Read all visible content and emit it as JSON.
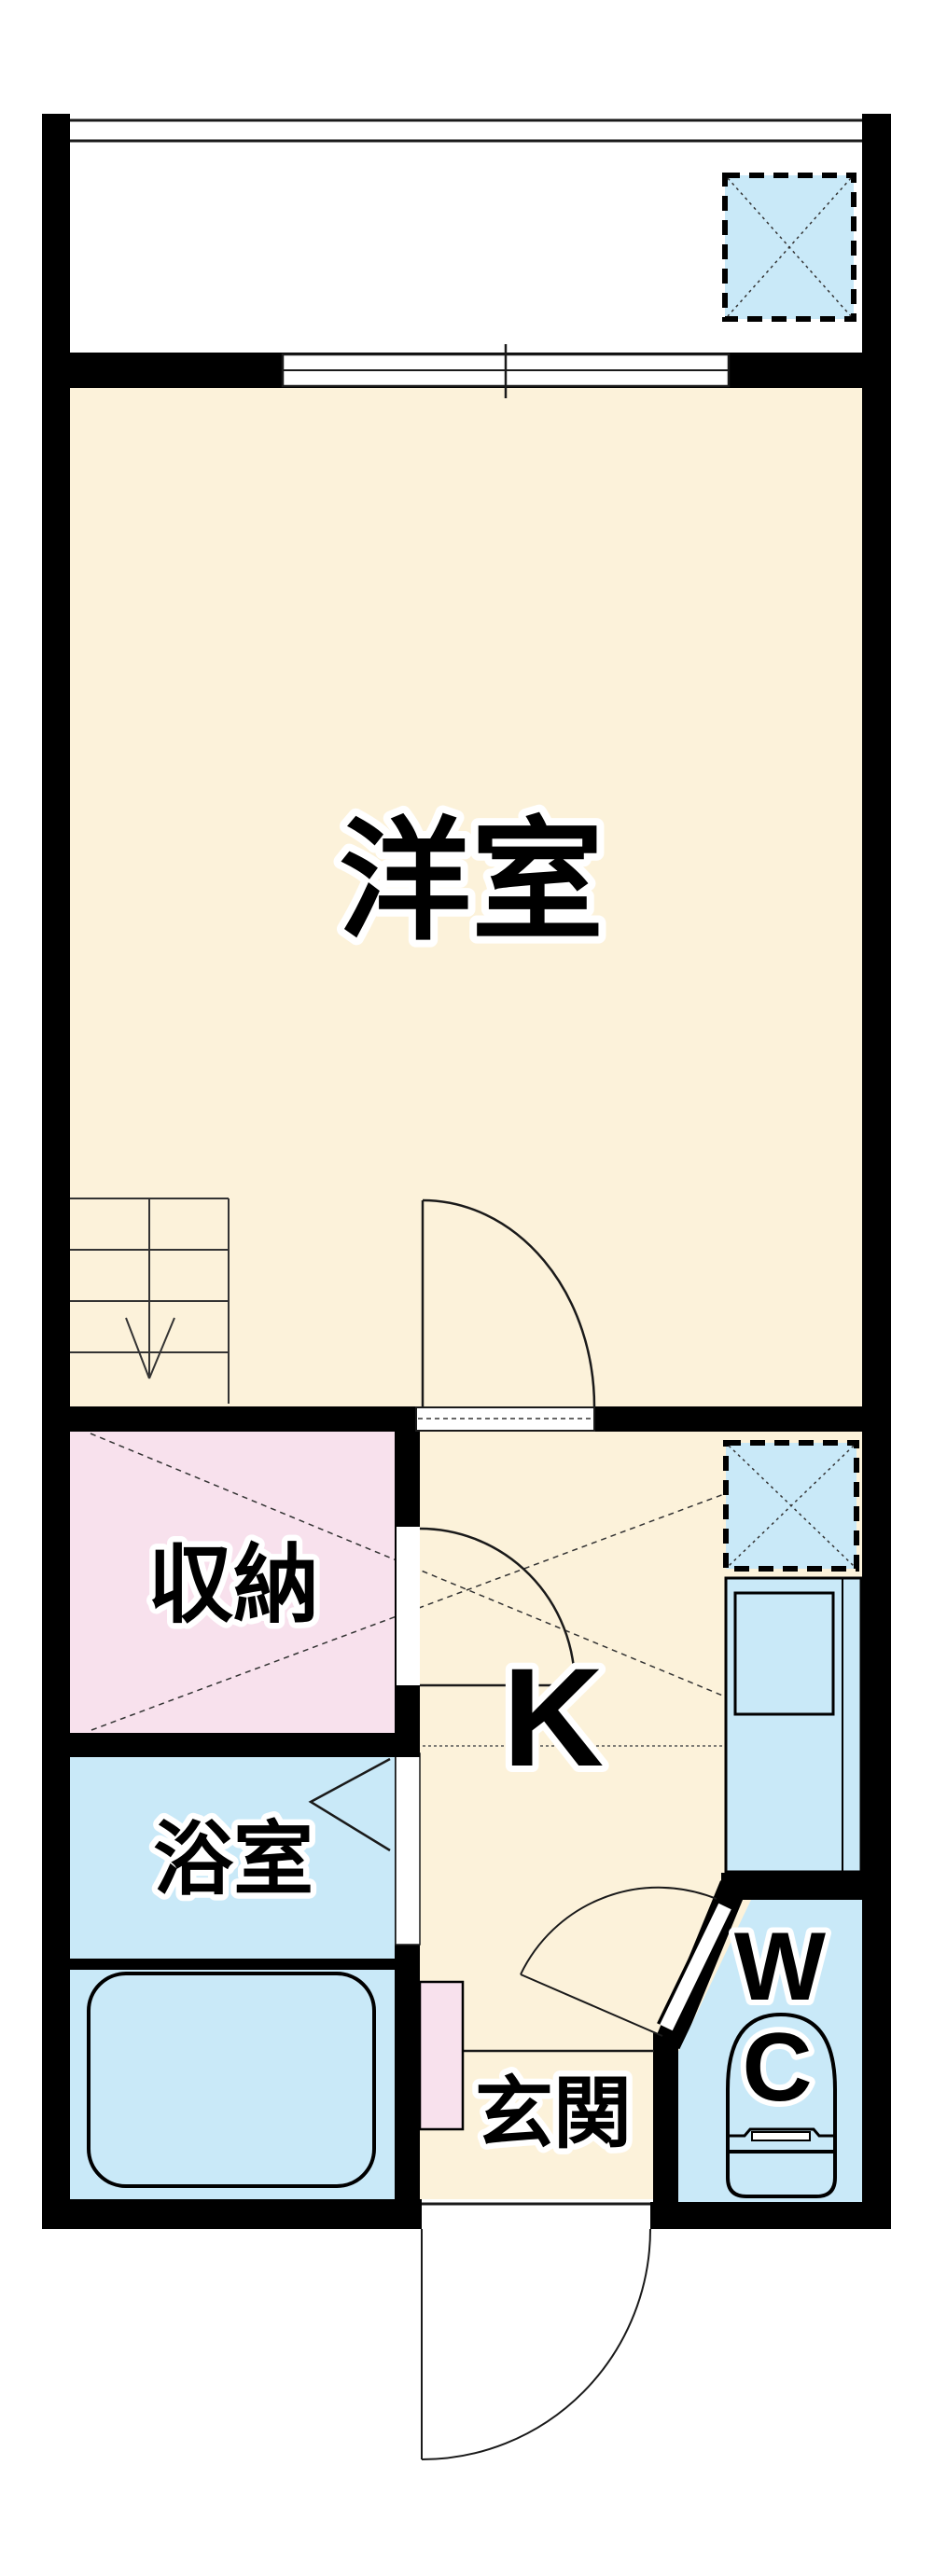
{
  "floorplan": {
    "title": "1K apartment floor plan",
    "rooms": {
      "western_room": {
        "label": "洋室"
      },
      "storage": {
        "label": "収納"
      },
      "bathroom": {
        "label": "浴室"
      },
      "kitchen": {
        "label": "K"
      },
      "entrance": {
        "label": "玄関"
      },
      "toilet": {
        "label_line1": "W",
        "label_line2": "C"
      }
    },
    "colors": {
      "wall_black": "#000000",
      "room_cream": "#FCF2DA",
      "room_pink": "#F8E1ED",
      "room_blue": "#C9E9F8",
      "line_dark": "#1a1a1a",
      "white": "#ffffff"
    }
  }
}
